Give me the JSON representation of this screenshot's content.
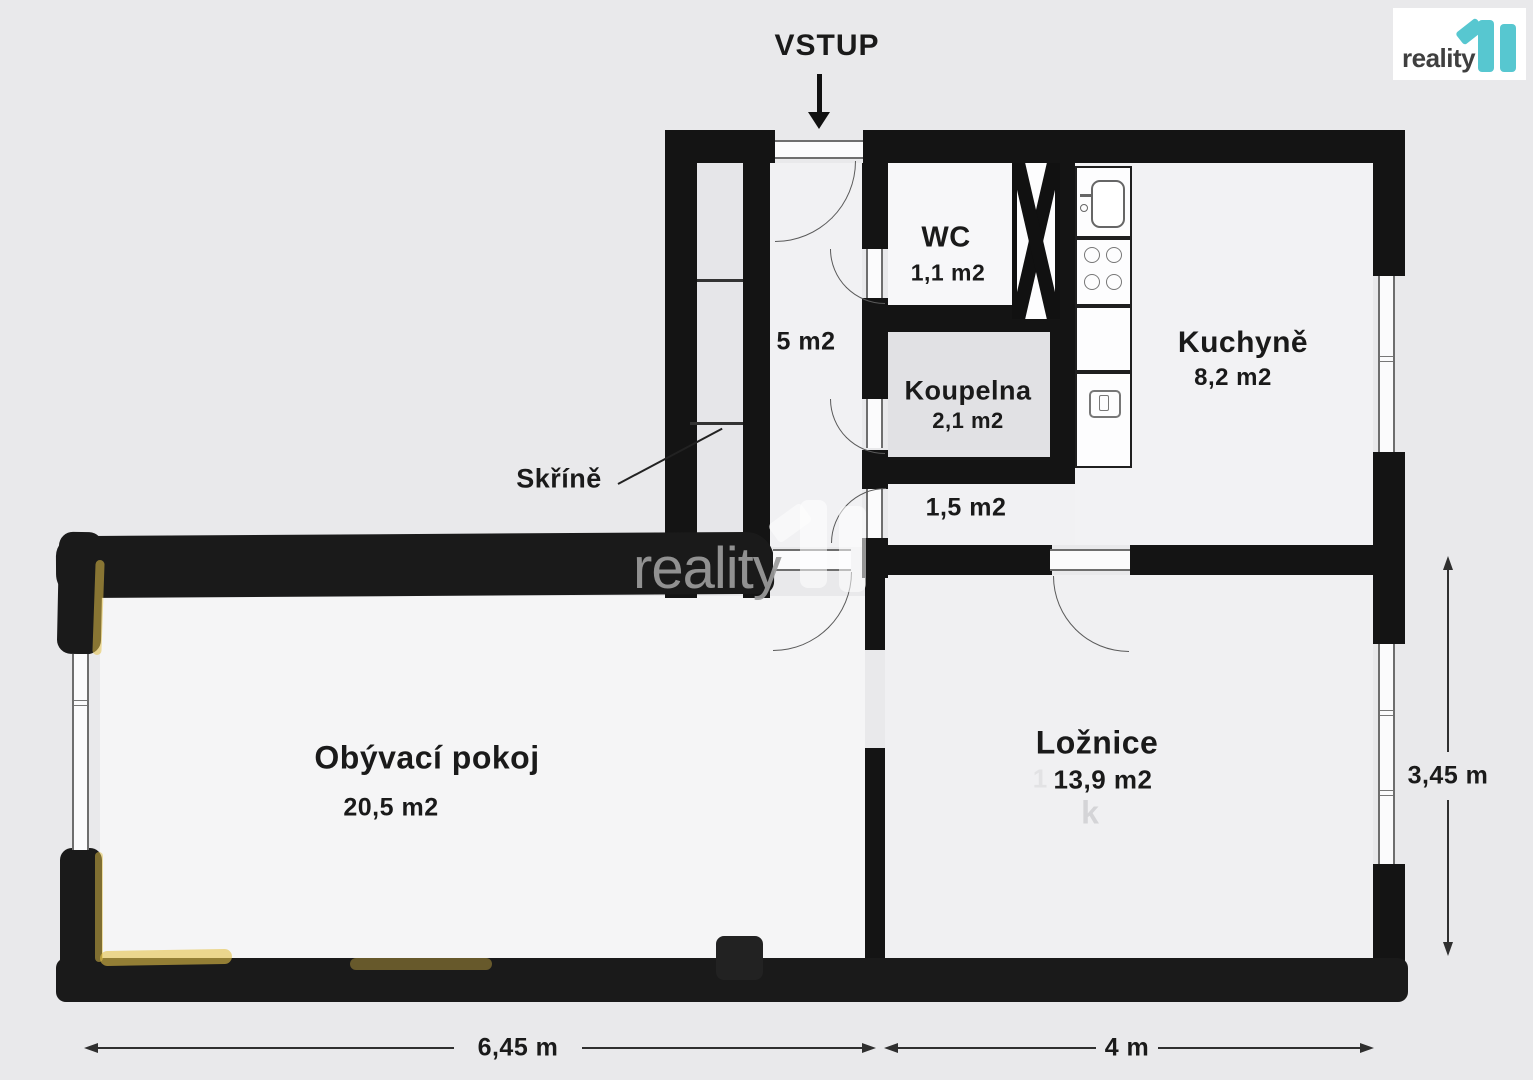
{
  "logo": {
    "brand": "reality",
    "suffix": "11"
  },
  "watermark": {
    "brand": "reality",
    "ghost_one": "1",
    "ghost_k": "k"
  },
  "entrance": {
    "label": "VSTUP"
  },
  "rooms": {
    "wc": {
      "name": "WC",
      "area": "1,1 m2"
    },
    "hallway": {
      "area": "5 m2"
    },
    "koupelna": {
      "name": "Koupelna",
      "area": "2,1 m2"
    },
    "corridor": {
      "area": "1,5 m2"
    },
    "kuchyne": {
      "name": "Kuchyně",
      "area": "8,2 m2"
    },
    "obyvaci_pokoj": {
      "name": "Obývací pokoj",
      "area": "20,5 m2"
    },
    "loznice": {
      "name": "Ložnice",
      "area": "13,9 m2"
    }
  },
  "annotations": {
    "closets": "Skříně"
  },
  "dimensions": {
    "bottom_left": "6,45 m",
    "bottom_right": "4 m",
    "right": "3,45 m"
  },
  "colors": {
    "wall": "#141414",
    "teal": "#57c7d0",
    "floor": "#f1f1f3",
    "background": "#e9e9eb",
    "highlight": "#e6c34a"
  }
}
